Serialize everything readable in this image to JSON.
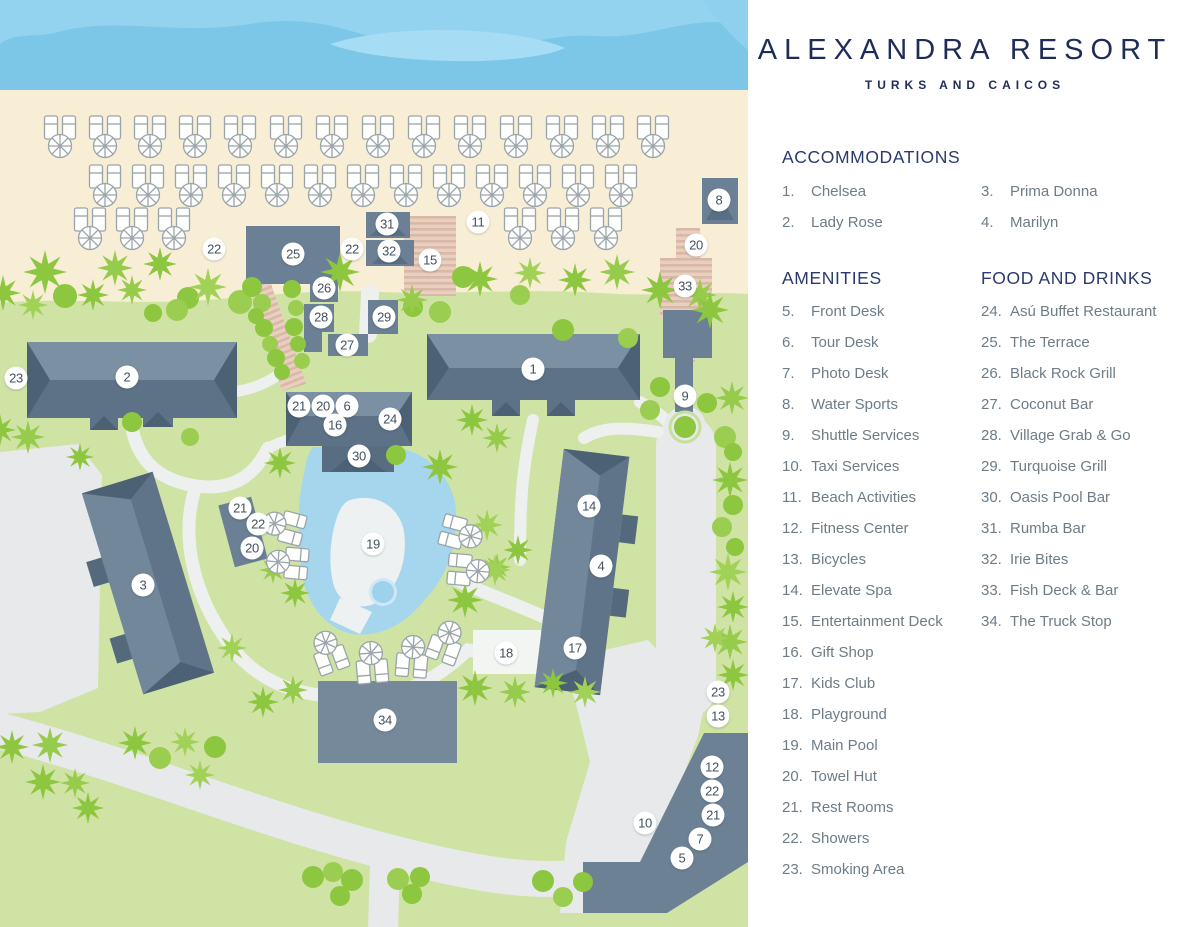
{
  "brand": {
    "title": "ALEXANDRA RESORT",
    "subtitle": "TURKS AND CAICOS"
  },
  "legend": {
    "accommodations": {
      "heading": "ACCOMMODATIONS",
      "col1": [
        {
          "num": "1.",
          "label": "Chelsea"
        },
        {
          "num": "2.",
          "label": "Lady Rose"
        }
      ],
      "col2": [
        {
          "num": "3.",
          "label": "Prima Donna"
        },
        {
          "num": "4.",
          "label": "Marilyn"
        }
      ]
    },
    "amenities": {
      "heading": "AMENITIES",
      "items": [
        {
          "num": "5.",
          "label": "Front Desk"
        },
        {
          "num": "6.",
          "label": "Tour Desk"
        },
        {
          "num": "7.",
          "label": "Photo Desk"
        },
        {
          "num": "8.",
          "label": "Water Sports"
        },
        {
          "num": "9.",
          "label": "Shuttle Services"
        },
        {
          "num": "10.",
          "label": "Taxi Services"
        },
        {
          "num": "11.",
          "label": "Beach Activities"
        },
        {
          "num": "12.",
          "label": "Fitness Center"
        },
        {
          "num": "13.",
          "label": "Bicycles"
        },
        {
          "num": "14.",
          "label": "Elevate Spa"
        },
        {
          "num": "15.",
          "label": "Entertainment Deck"
        },
        {
          "num": "16.",
          "label": "Gift Shop"
        },
        {
          "num": "17.",
          "label": "Kids Club"
        },
        {
          "num": "18.",
          "label": "Playground"
        },
        {
          "num": "19.",
          "label": "Main Pool"
        },
        {
          "num": "20.",
          "label": "Towel Hut"
        },
        {
          "num": "21.",
          "label": "Rest Rooms"
        },
        {
          "num": "22.",
          "label": "Showers"
        },
        {
          "num": "23.",
          "label": "Smoking Area"
        }
      ]
    },
    "food": {
      "heading": "FOOD AND DRINKS",
      "items": [
        {
          "num": "24.",
          "label": "Asú Buffet Restaurant"
        },
        {
          "num": "25.",
          "label": "The Terrace"
        },
        {
          "num": "26.",
          "label": "Black Rock Grill"
        },
        {
          "num": "27.",
          "label": "Coconut Bar"
        },
        {
          "num": "28.",
          "label": "Village Grab & Go"
        },
        {
          "num": "29.",
          "label": "Turquoise Grill"
        },
        {
          "num": "30.",
          "label": "Oasis Pool Bar"
        },
        {
          "num": "31.",
          "label": "Rumba Bar"
        },
        {
          "num": "32.",
          "label": "Irie Bites"
        },
        {
          "num": "33.",
          "label": "Fish Deck & Bar"
        },
        {
          "num": "34.",
          "label": "The Truck Stop"
        }
      ]
    }
  },
  "map": {
    "markers": [
      {
        "n": "22",
        "x": 214,
        "y": 249
      },
      {
        "n": "25",
        "x": 293,
        "y": 254
      },
      {
        "n": "22",
        "x": 352,
        "y": 249
      },
      {
        "n": "31",
        "x": 387,
        "y": 224
      },
      {
        "n": "32",
        "x": 389,
        "y": 251
      },
      {
        "n": "15",
        "x": 430,
        "y": 260
      },
      {
        "n": "11",
        "x": 478,
        "y": 222
      },
      {
        "n": "8",
        "x": 719,
        "y": 200
      },
      {
        "n": "20",
        "x": 696,
        "y": 245
      },
      {
        "n": "33",
        "x": 685,
        "y": 286
      },
      {
        "n": "26",
        "x": 324,
        "y": 288
      },
      {
        "n": "28",
        "x": 321,
        "y": 317
      },
      {
        "n": "29",
        "x": 384,
        "y": 317
      },
      {
        "n": "27",
        "x": 347,
        "y": 345
      },
      {
        "n": "23",
        "x": 16,
        "y": 378
      },
      {
        "n": "2",
        "x": 127,
        "y": 377
      },
      {
        "n": "1",
        "x": 533,
        "y": 369
      },
      {
        "n": "9",
        "x": 685,
        "y": 396
      },
      {
        "n": "21",
        "x": 299,
        "y": 406
      },
      {
        "n": "20",
        "x": 323,
        "y": 406
      },
      {
        "n": "6",
        "x": 347,
        "y": 406
      },
      {
        "n": "16",
        "x": 335,
        "y": 425
      },
      {
        "n": "24",
        "x": 390,
        "y": 419
      },
      {
        "n": "30",
        "x": 359,
        "y": 456
      },
      {
        "n": "14",
        "x": 589,
        "y": 506
      },
      {
        "n": "21",
        "x": 240,
        "y": 508
      },
      {
        "n": "22",
        "x": 258,
        "y": 524
      },
      {
        "n": "20",
        "x": 252,
        "y": 548
      },
      {
        "n": "19",
        "x": 373,
        "y": 544
      },
      {
        "n": "3",
        "x": 143,
        "y": 585
      },
      {
        "n": "4",
        "x": 601,
        "y": 566
      },
      {
        "n": "17",
        "x": 575,
        "y": 648
      },
      {
        "n": "18",
        "x": 506,
        "y": 653
      },
      {
        "n": "23",
        "x": 718,
        "y": 692
      },
      {
        "n": "13",
        "x": 718,
        "y": 716
      },
      {
        "n": "34",
        "x": 385,
        "y": 720
      },
      {
        "n": "12",
        "x": 712,
        "y": 767
      },
      {
        "n": "22",
        "x": 712,
        "y": 791
      },
      {
        "n": "21",
        "x": 713,
        "y": 815
      },
      {
        "n": "10",
        "x": 645,
        "y": 823
      },
      {
        "n": "7",
        "x": 700,
        "y": 839
      },
      {
        "n": "5",
        "x": 682,
        "y": 858
      }
    ]
  },
  "colors": {
    "navy": "#1f2c58",
    "heading_navy": "#2b3a6e",
    "list_gray": "#6e7c87",
    "ocean": "#7cc7e7",
    "wave": "#93d3f0",
    "sand": "#f7eed5",
    "grass": "#cfe3a5",
    "road": "#e7e9ea",
    "building": "#5d7286",
    "building_light": "#7b90a2",
    "building_flat": "#6b8094",
    "deck_pink": "#e9cfc0",
    "deck_stripe": "#d9b8a7",
    "pool": "#a6d6ee",
    "palm": "#8dc63f"
  }
}
